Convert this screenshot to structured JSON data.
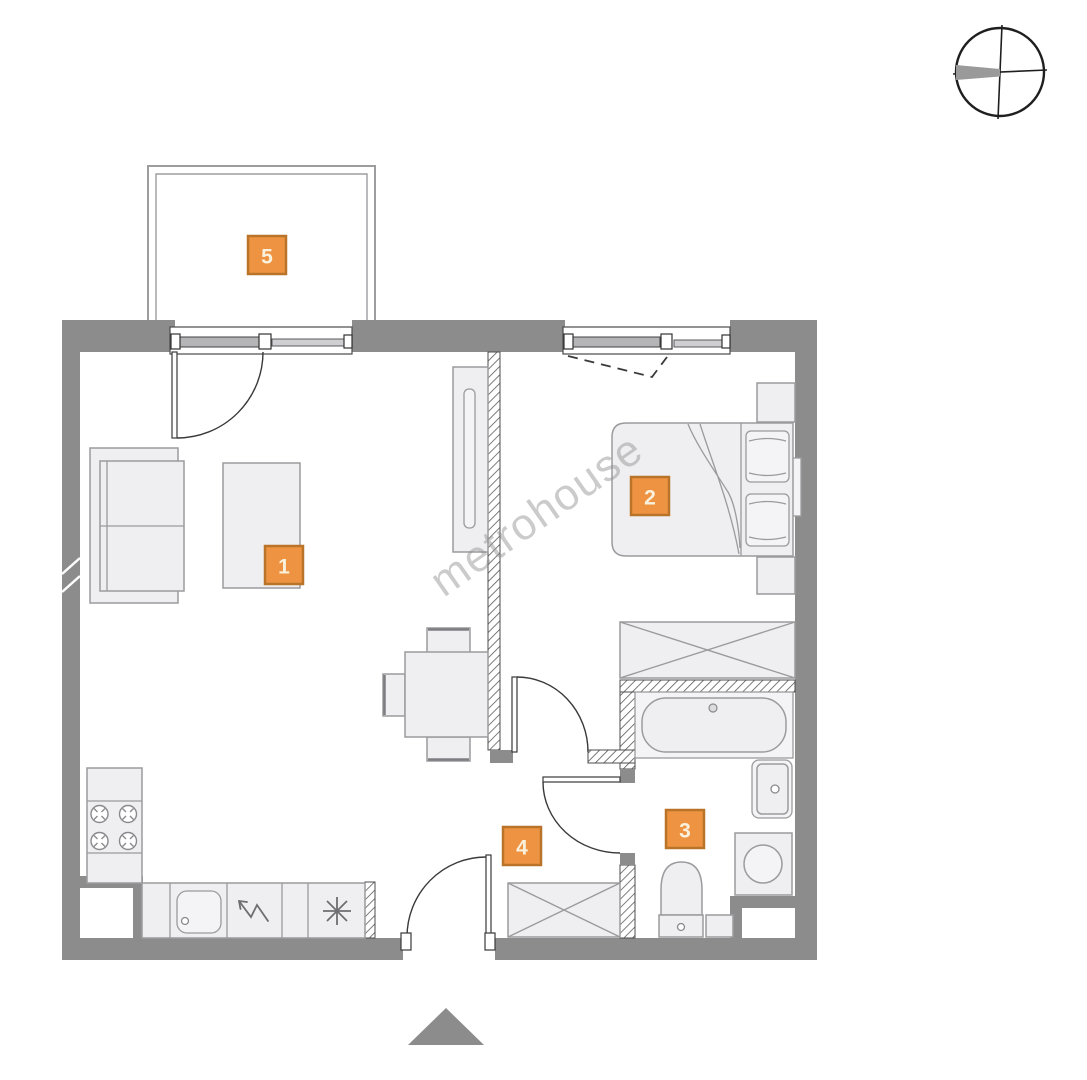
{
  "watermark_text": "metrohouse",
  "labels": [
    {
      "number": "1"
    },
    {
      "number": "2"
    },
    {
      "number": "3"
    },
    {
      "number": "4"
    },
    {
      "number": "5"
    }
  ],
  "colors": {
    "wall_gray": "#8c8c8c",
    "label_fill": "#ee9342",
    "label_border": "#b9742a",
    "label_text": "#f9f1dc",
    "furniture_fill": "#efeff1",
    "furniture_stroke": "#9b9b9e"
  },
  "icons": {
    "compass": "compass-rose-icon",
    "entrance_marker": "triangle-up-icon"
  }
}
